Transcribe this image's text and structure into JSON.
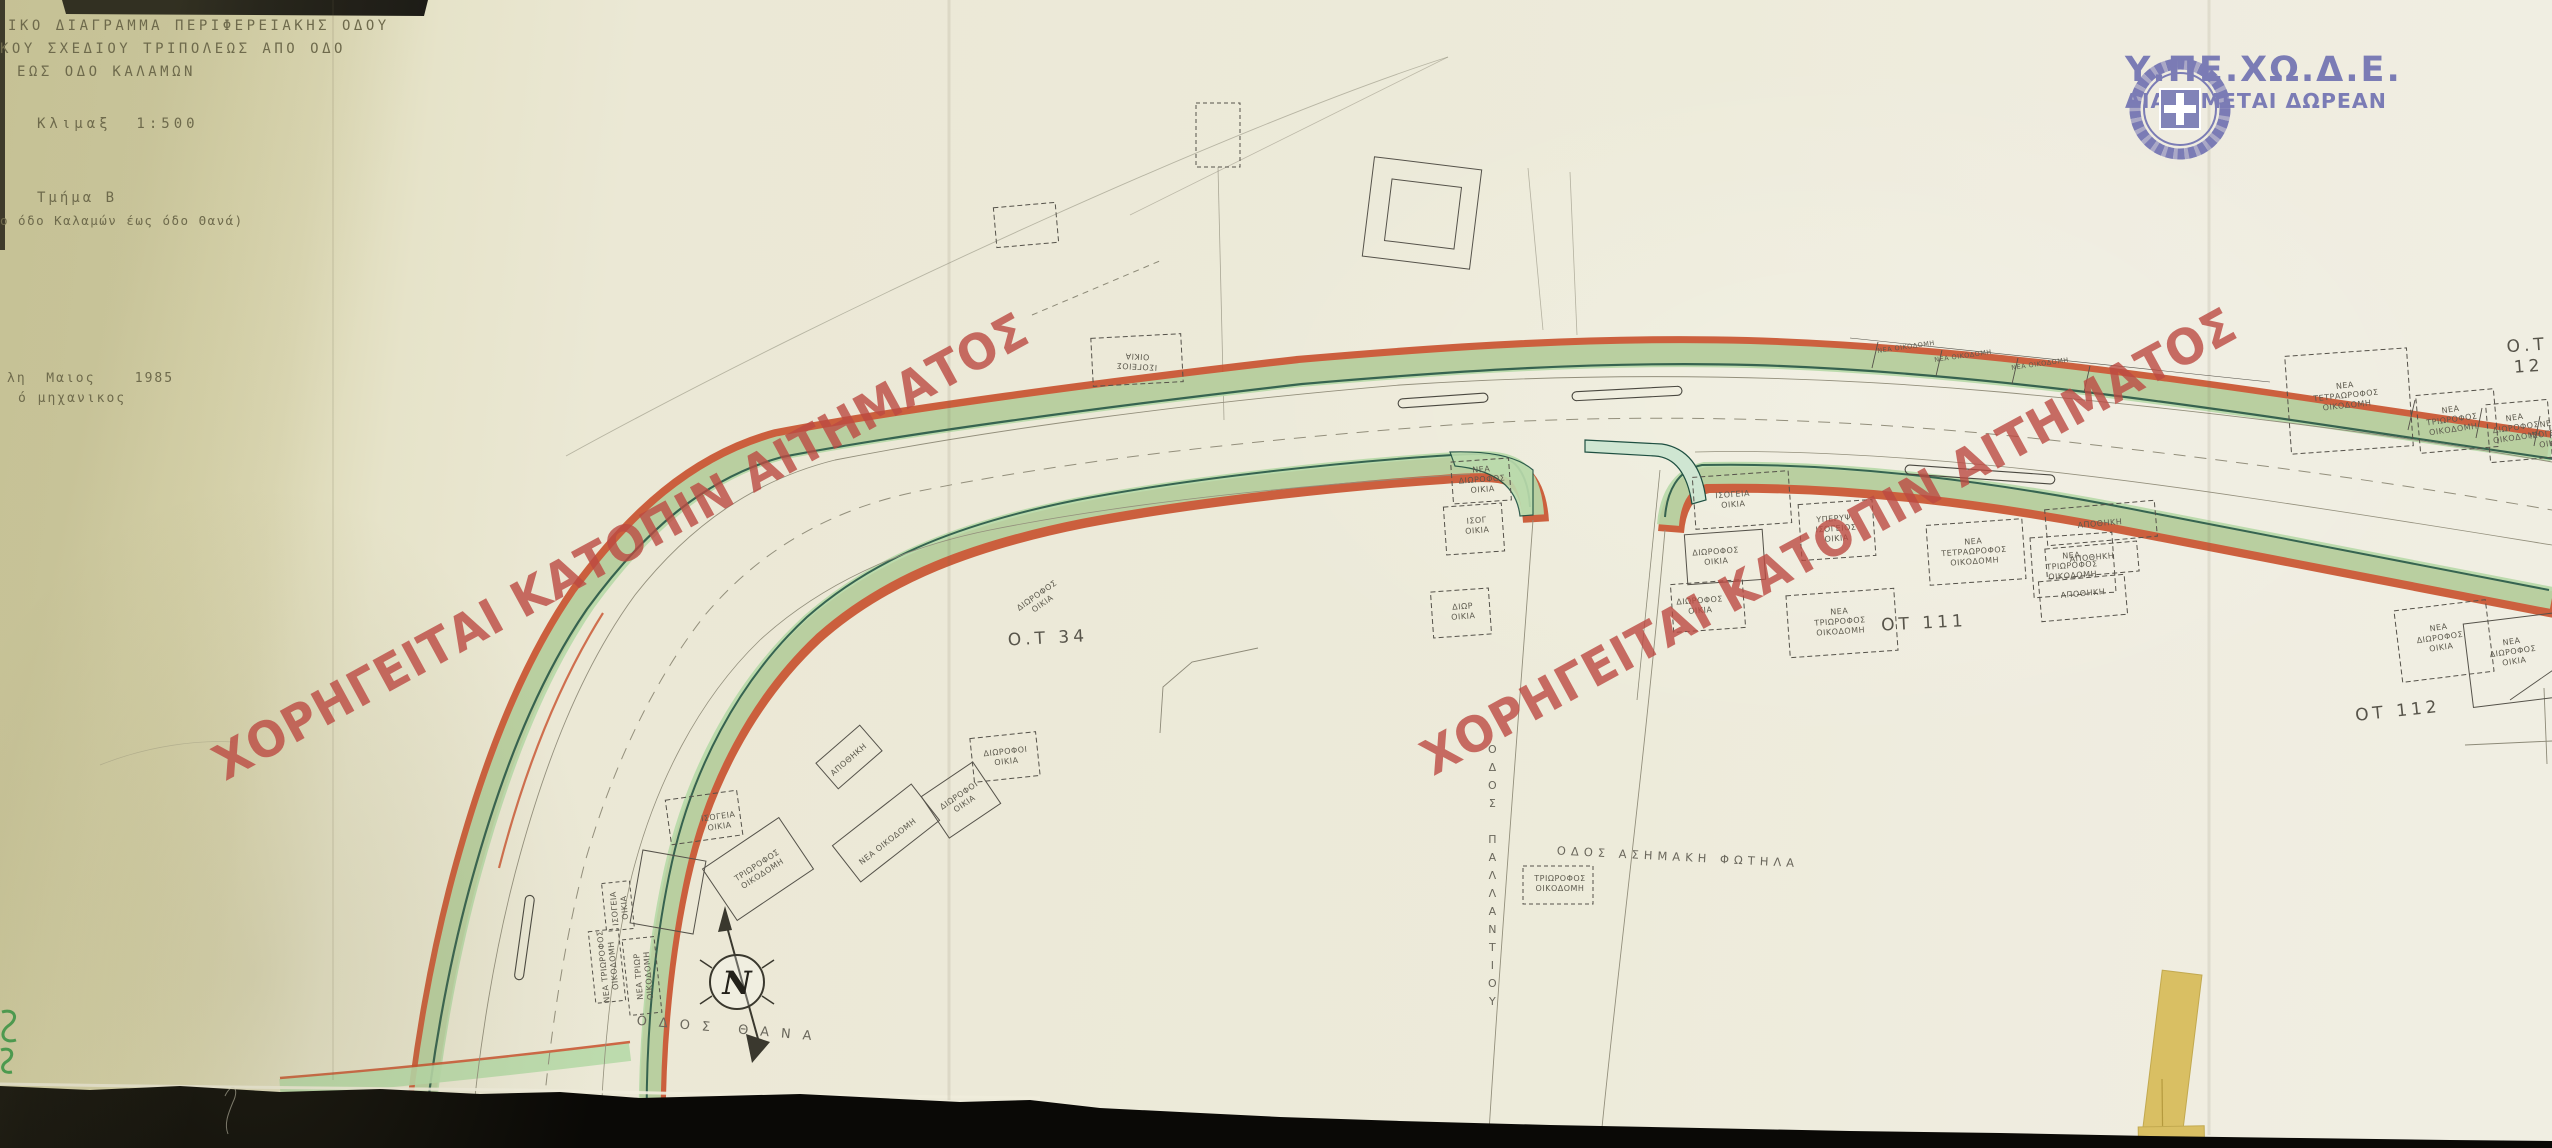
{
  "document": {
    "title_line1": "ΙΚΟ ΔΙΑΓΡΑΜΜΑ ΠΕΡΙΦΕΡΕΙΑΚΗΣ ΟΔΟΥ",
    "title_line2": "ΚΟΥ ΣΧΕΔΙΟΥ ΤΡΙΠΟΛΕΩΣ ΑΠΟ ΟΔΟ",
    "title_line3": "ΕΩΣ ΟΔΟ ΚΑΛΑΜΩΝ",
    "scale_label": "Κλιμαξ  1:500",
    "section_label": "Τμήμα Β",
    "section_note": "ο όδο Καλαμών έως όδο Θανά)",
    "date_line": "λη  Μαιος    1985",
    "signature_line": "ό μηχανικος"
  },
  "agency": {
    "name": "Υ.ΠΕ.ΧΩ.Δ.Ε.",
    "distribution": "ΔΙΑΝΕΜΕΤΑΙ ΔΩΡΕΑΝ",
    "color": "#7b7cb5",
    "emblem": "wreath-cross-emblem"
  },
  "watermark": {
    "text": "ΧΟΡΗΓΕΙΤΑΙ ΚΑΤΟΠΙΝ ΑΙΤΗΜΑΤΟΣ",
    "color": "#bc4a42",
    "instances": [
      {
        "x": 230,
        "y": 738
      },
      {
        "x": 1438,
        "y": 733
      }
    ]
  },
  "map": {
    "north_label": "N",
    "colors": {
      "verge_green": "#b7d9a8",
      "limit_red": "#c8502c",
      "edge_teal": "#1e4f41",
      "paper": "#ebe8d5"
    },
    "labels": [
      {
        "t": "Ο.Τ 34",
        "x": 1048,
        "y": 639,
        "r": -3,
        "c": "ot",
        "n": "block-label-ot34"
      },
      {
        "t": "ΟΤ 111",
        "x": 1924,
        "y": 624,
        "r": -3,
        "c": "ot",
        "n": "block-label-ot111"
      },
      {
        "t": "ΟΤ 112",
        "x": 2398,
        "y": 712,
        "r": -6,
        "c": "ot",
        "n": "block-label-ot112"
      },
      {
        "t": "Ο.Τ 12",
        "x": 2528,
        "y": 357,
        "r": -4,
        "c": "ot",
        "n": "block-label-ot12"
      },
      {
        "t": "ΟΔΟΣ ΘΑΝΑ",
        "x": 730,
        "y": 1030,
        "r": 5,
        "c": "street",
        "n": "street-label-odos-thana"
      },
      {
        "t": "ΟΔΟΣ ΑΣΗΜΑΚΗ ΦΩΤΗΛΑ",
        "x": 1678,
        "y": 857,
        "r": 3,
        "c": "street2",
        "n": "street-label-asimaki-fotila"
      },
      {
        "t": "ΟΔΟΣ ΠΑΛΛΑΝΤΙΟΥ",
        "x": 1492,
        "y": 878,
        "r": 0,
        "c": "street-v",
        "n": "street-label-pallantiou"
      },
      {
        "t": "ΙΣΟΓΕΙΟΣ\nΟΙΚΙΑ",
        "x": 1137,
        "y": 361,
        "r": 183
      },
      {
        "t": "ΙΣΟΓΕΙΑ\nΟΙΚΙΑ",
        "x": 719,
        "y": 822,
        "r": -8
      },
      {
        "t": "ΤΡΙΩΡΟΦΟΣ\nΟΙΚΟΔΟΜΗ",
        "x": 760,
        "y": 870,
        "r": -33
      },
      {
        "t": "ΝΕΑ ΟΙΚΟΔΟΜΗ",
        "x": 888,
        "y": 842,
        "r": -38
      },
      {
        "t": "ΑΠΟΘΗΚΗ",
        "x": 849,
        "y": 760,
        "r": -41
      },
      {
        "t": "ΔΙΩΡΟΦΟΙ\nΟΙΚΙΑ",
        "x": 1006,
        "y": 757,
        "r": -6
      },
      {
        "t": "ΔΙΩΡΟΦΟΙ\nΟΙΚΙΑ",
        "x": 962,
        "y": 800,
        "r": -34
      },
      {
        "t": "ΝΕΑ ΤΡΙΩΡΟΦΟΣ\nΟΙΚΟΔΟΜΗ",
        "x": 609,
        "y": 966,
        "r": -96
      },
      {
        "t": "ΝΕΑ ΤΡΙΩΡ\nΟΙΚΟΔΟΜΗ",
        "x": 644,
        "y": 976,
        "r": -95
      },
      {
        "t": "ΙΣΟΓΕΙΑ\nΟΙΚΙΑ",
        "x": 620,
        "y": 908,
        "r": -95
      },
      {
        "t": "ΔΙΩΡΟΦΟΣ\nΟΙΚΙΑ",
        "x": 1040,
        "y": 600,
        "r": -35
      },
      {
        "t": "ΝΕΑ\nΔΙΩΡΟΦΟΣ\nΟΙΚΙΑ",
        "x": 1482,
        "y": 480,
        "r": -4
      },
      {
        "t": "ΙΣΟΓ\nΟΙΚΙΑ",
        "x": 1477,
        "y": 526,
        "r": -4
      },
      {
        "t": "ΔΙΩΡ\nΟΙΚΙΑ",
        "x": 1463,
        "y": 612,
        "r": -4
      },
      {
        "t": "ΙΣΟΓΕΙΑ\nΟΙΚΙΑ",
        "x": 1733,
        "y": 500,
        "r": -4
      },
      {
        "t": "ΔΙΩΡΟΦΟΣ\nΟΙΚΙΑ",
        "x": 1716,
        "y": 557,
        "r": -4
      },
      {
        "t": "ΔΙΩΡΟΦΟΣ\nΟΙΚΙΑ",
        "x": 1700,
        "y": 606,
        "r": -4
      },
      {
        "t": "ΥΠΕΡΥΨ.\nΙΣΟΓΕΙΟΣ\nΟΙΚΙΑ",
        "x": 1836,
        "y": 529,
        "r": -4
      },
      {
        "t": "ΝΕΑ\nΤΡΙΩΡΟΦΟΣ\nΟΙΚΟΔΟΜΗ",
        "x": 1840,
        "y": 622,
        "r": -4
      },
      {
        "t": "ΝΕΑ\nΤΕΤΡΑΩΡΟΦΟΣ\nΟΙΚΟΔΟΜΗ",
        "x": 1974,
        "y": 552,
        "r": -4
      },
      {
        "t": "ΝΕΑ\nΤΡΙΩΡΟΦΟΣ\nΟΙΚΟΔΟΜΗ",
        "x": 2072,
        "y": 566,
        "r": -4
      },
      {
        "t": "ΑΠΟΘΗΚΗ",
        "x": 2100,
        "y": 524,
        "r": -5
      },
      {
        "t": "ΑΠΟΘΗΚΗ",
        "x": 2092,
        "y": 558,
        "r": -5
      },
      {
        "t": "ΑΠΟΘΗΚΗ",
        "x": 2083,
        "y": 594,
        "r": -5
      },
      {
        "t": "ΝΕΑ ΟΙΚΟΔΟΜΗ",
        "x": 1906,
        "y": 347,
        "r": -8,
        "s": 6.5
      },
      {
        "t": "ΝΕΑ ΟΙΚΟΔΟΜΗ",
        "x": 1963,
        "y": 356,
        "r": -8,
        "s": 6.5
      },
      {
        "t": "ΝΕΑ ΟΙΚΟΔΟΜΗ",
        "x": 2040,
        "y": 364,
        "r": -8,
        "s": 6.5
      },
      {
        "t": "ΝΕΑ\nΤΕΤΡΑΩΡΟΦΟΣ\nΟΙΚΟΔΟΜΗ",
        "x": 2346,
        "y": 396,
        "r": -6
      },
      {
        "t": "ΝΕΑ\nΤΡΙΩΡΟΦΟΣ\nΟΙΚΟΔΟΜΗ",
        "x": 2452,
        "y": 420,
        "r": -8
      },
      {
        "t": "ΝΕΑ\nΔΙΩΡΟΦΟΣ\nΟΙΚΟΔΟΜΗ",
        "x": 2516,
        "y": 428,
        "r": -8
      },
      {
        "t": "ΝΕΑ\nΙΣΟΓΕΙΟΣ\nΟΙΚΙΑ",
        "x": 2550,
        "y": 434,
        "r": -8
      },
      {
        "t": "ΝΕΑ\nΔΙΩΡΟΦΟΣ\nΟΙΚΙΑ",
        "x": 2440,
        "y": 638,
        "r": -8
      },
      {
        "t": "ΝΕΑ\nΔΙΩΡΟΦΟΣ\nΟΙΚΙΑ",
        "x": 2513,
        "y": 652,
        "r": -8
      },
      {
        "t": "ΤΡΙΩΡΟΦΟΣ\nΟΙΚΟΔΟΜΗ",
        "x": 1560,
        "y": 884,
        "r": 0
      }
    ]
  }
}
